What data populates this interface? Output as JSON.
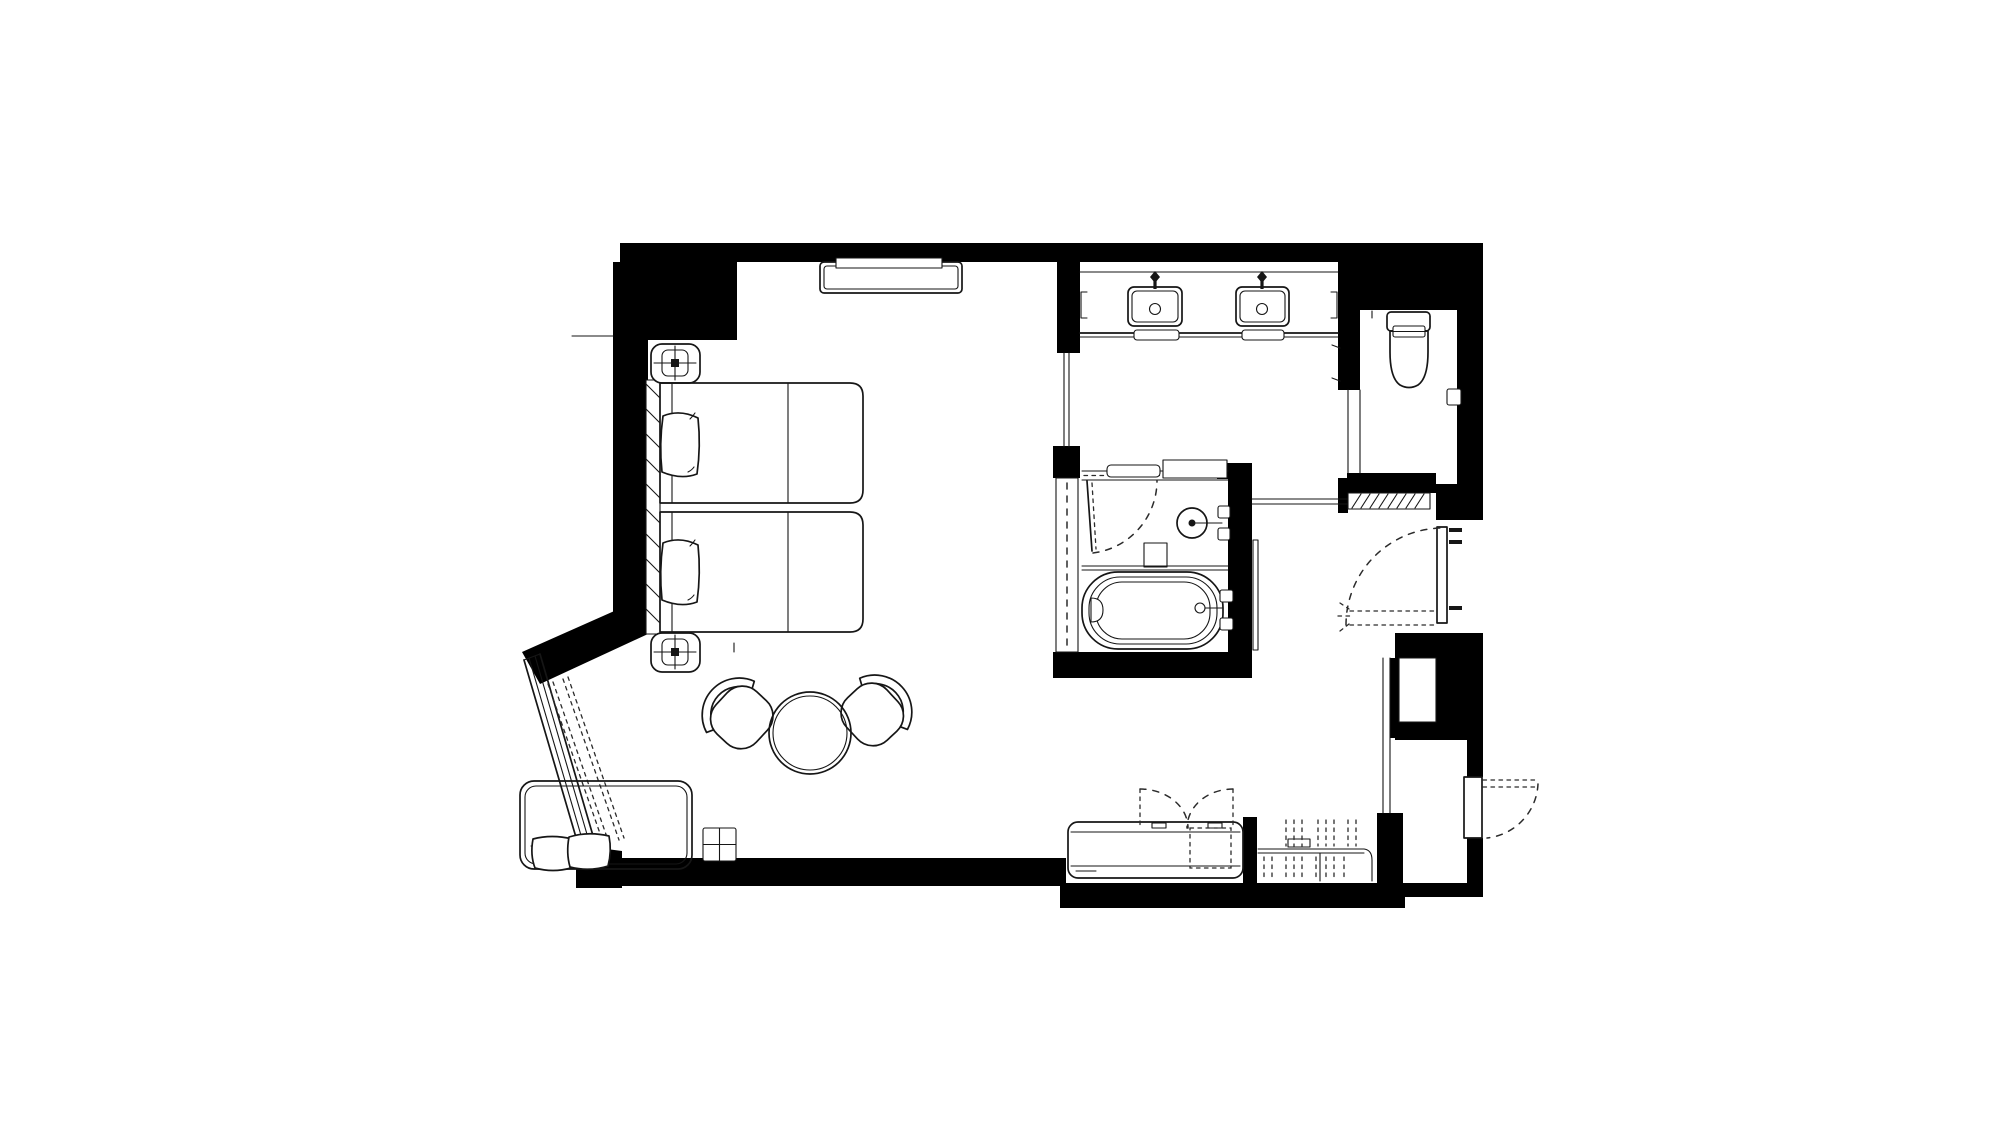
{
  "meta": {
    "title": "hotel-guestroom-floor-plan",
    "canvas_width": 2000,
    "canvas_height": 1125,
    "drawing_type": "architectural floor plan, black line work on white"
  },
  "colors": {
    "background": "#ffffff",
    "wall_fill": "#000000",
    "linework": "#161616",
    "dashed_linework": "#2b2b2b"
  },
  "rooms": [
    {
      "id": "bedroom",
      "contents": [
        "tv-credenza",
        "nightstand-north",
        "nightstand-south",
        "bed-1",
        "bed-2",
        "headboard",
        "lounge-chair-left",
        "lounge-chair-right",
        "round-table",
        "sofa",
        "side-table",
        "angled-window"
      ]
    },
    {
      "id": "vanity-room",
      "contents": [
        "vanity-counter",
        "sink-left",
        "sink-right",
        "towel-bar-left",
        "towel-bar-right",
        "towel-shelf-left",
        "towel-shelf-right"
      ]
    },
    {
      "id": "wet-room",
      "contents": [
        "shower-head",
        "shower-valves",
        "shower-bench",
        "bathtub",
        "tub-faucet",
        "glass-partition",
        "swing-door"
      ]
    },
    {
      "id": "wc",
      "contents": [
        "toilet",
        "toilet-paper-holder"
      ]
    },
    {
      "id": "entry-hall",
      "contents": [
        "sliding-pocket-door",
        "entry-door",
        "connecting-door",
        "luggage-bench",
        "wardrobe-rod",
        "closet-niche"
      ]
    }
  ],
  "doors": [
    {
      "id": "entry-door",
      "type": "hinged",
      "swing": "dashed-arc"
    },
    {
      "id": "wet-room-door",
      "type": "hinged",
      "swing": "dashed-arc"
    },
    {
      "id": "sliding-pocket-door",
      "type": "sliding",
      "leaf": "hatched"
    },
    {
      "id": "connecting-door",
      "type": "hinged",
      "swing": "dashed-arc-exterior"
    },
    {
      "id": "bench-cabinet-doors",
      "type": "double-swing",
      "swing": "dashed-arcs"
    }
  ],
  "symbols": {
    "lamp": "rounded square with cross on nightstands",
    "curtain": "dashed parallel lines inside window",
    "hangers": "short dashed vertical strokes in wardrobe",
    "headboard": "hatched strip along bed wall"
  }
}
